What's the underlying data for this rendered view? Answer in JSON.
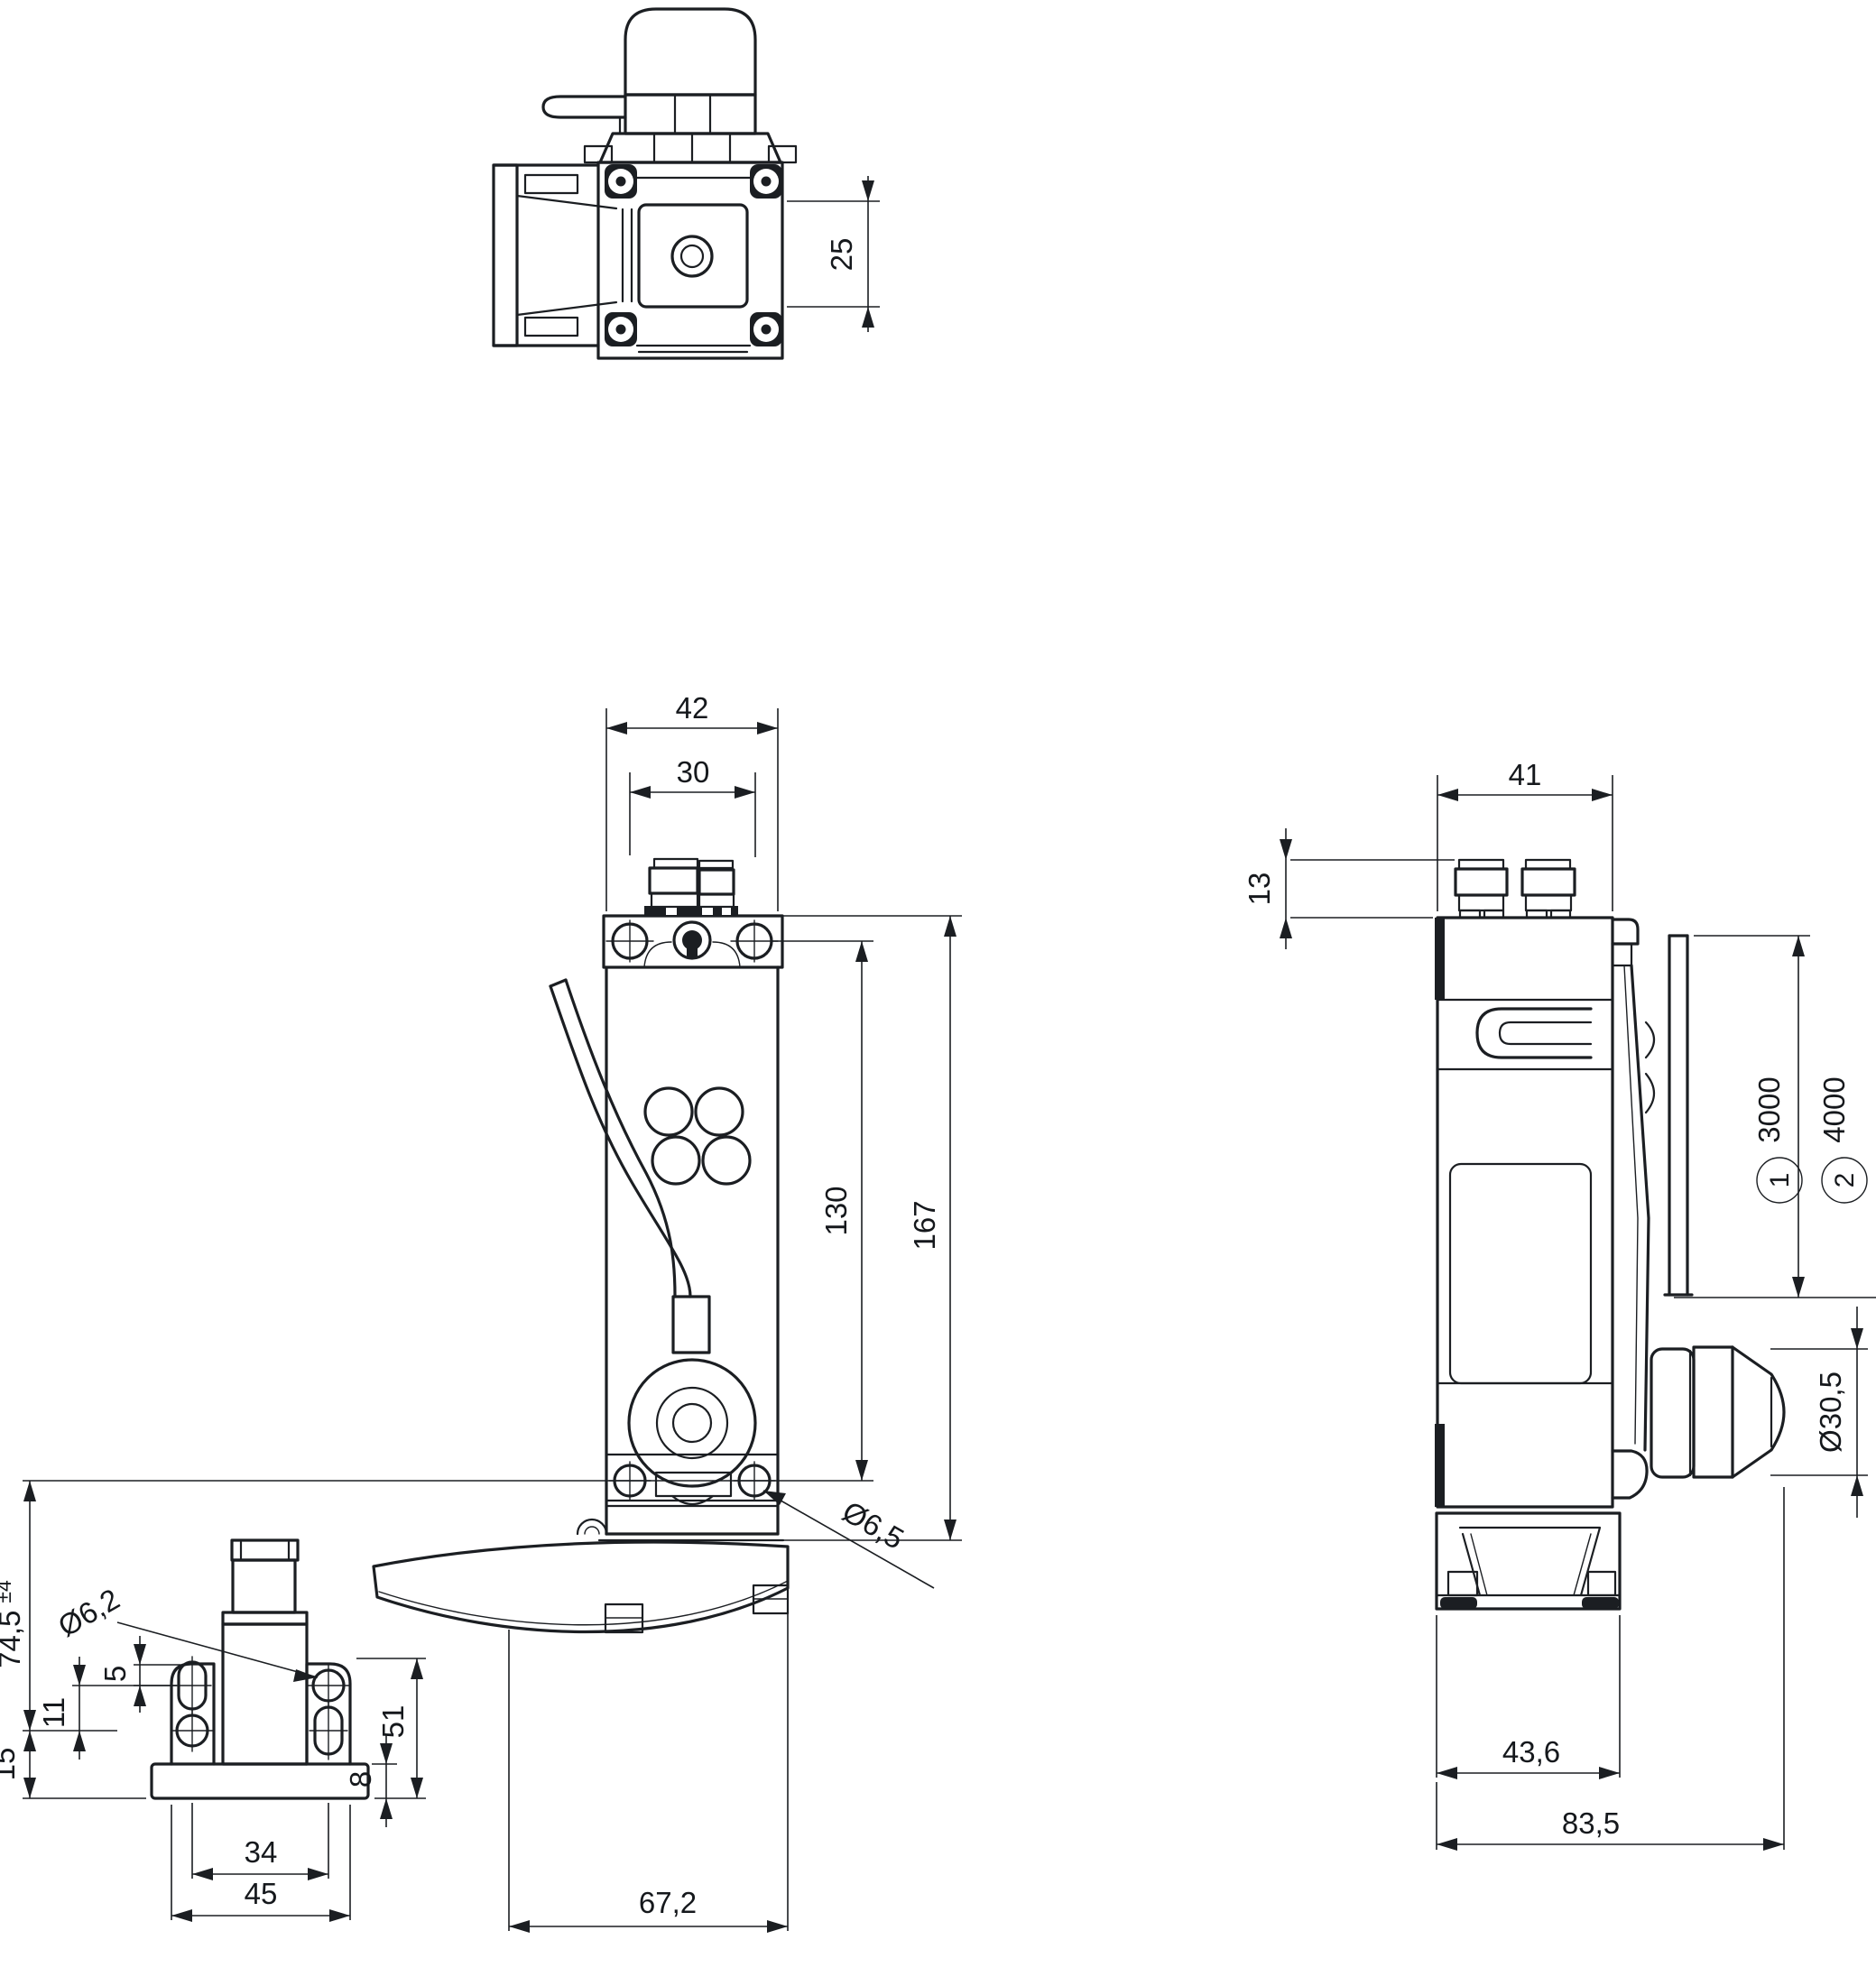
{
  "drawing": {
    "title": "safety-hinge-switch-dimensional-drawing",
    "units": "mm",
    "line_color": "#1b1e22",
    "background_color": "#ffffff"
  },
  "views": {
    "top": {
      "label": "top-view",
      "dims": {
        "depth": "25"
      }
    },
    "front": {
      "label": "front-view",
      "dims": {
        "width": "42",
        "connector_spacing": "30",
        "hole_spacing_vertical": "130",
        "height": "167",
        "mounting_hole_dia": "Ø6,5",
        "lever_width": "67,2"
      }
    },
    "side": {
      "label": "side-view",
      "dims": {
        "width": "41",
        "connector_height": "13",
        "cable_length_1": "3000",
        "cable_length_2": "4000",
        "callout_1": "1",
        "callout_2": "2",
        "head_dia": "Ø30,5",
        "foot_width": "43,6",
        "total_depth": "83,5"
      }
    },
    "bracket": {
      "label": "hinge-bracket-view",
      "dims": {
        "axis_to_base": "74,5",
        "tolerance": "±4",
        "base_offset": "15",
        "hole_row_spacing": "11",
        "slot_play": "5",
        "hole_dia": "Ø6,2",
        "bracket_height": "51",
        "plate_thickness": "8",
        "hole_spacing": "34",
        "bracket_width": "45"
      }
    }
  }
}
